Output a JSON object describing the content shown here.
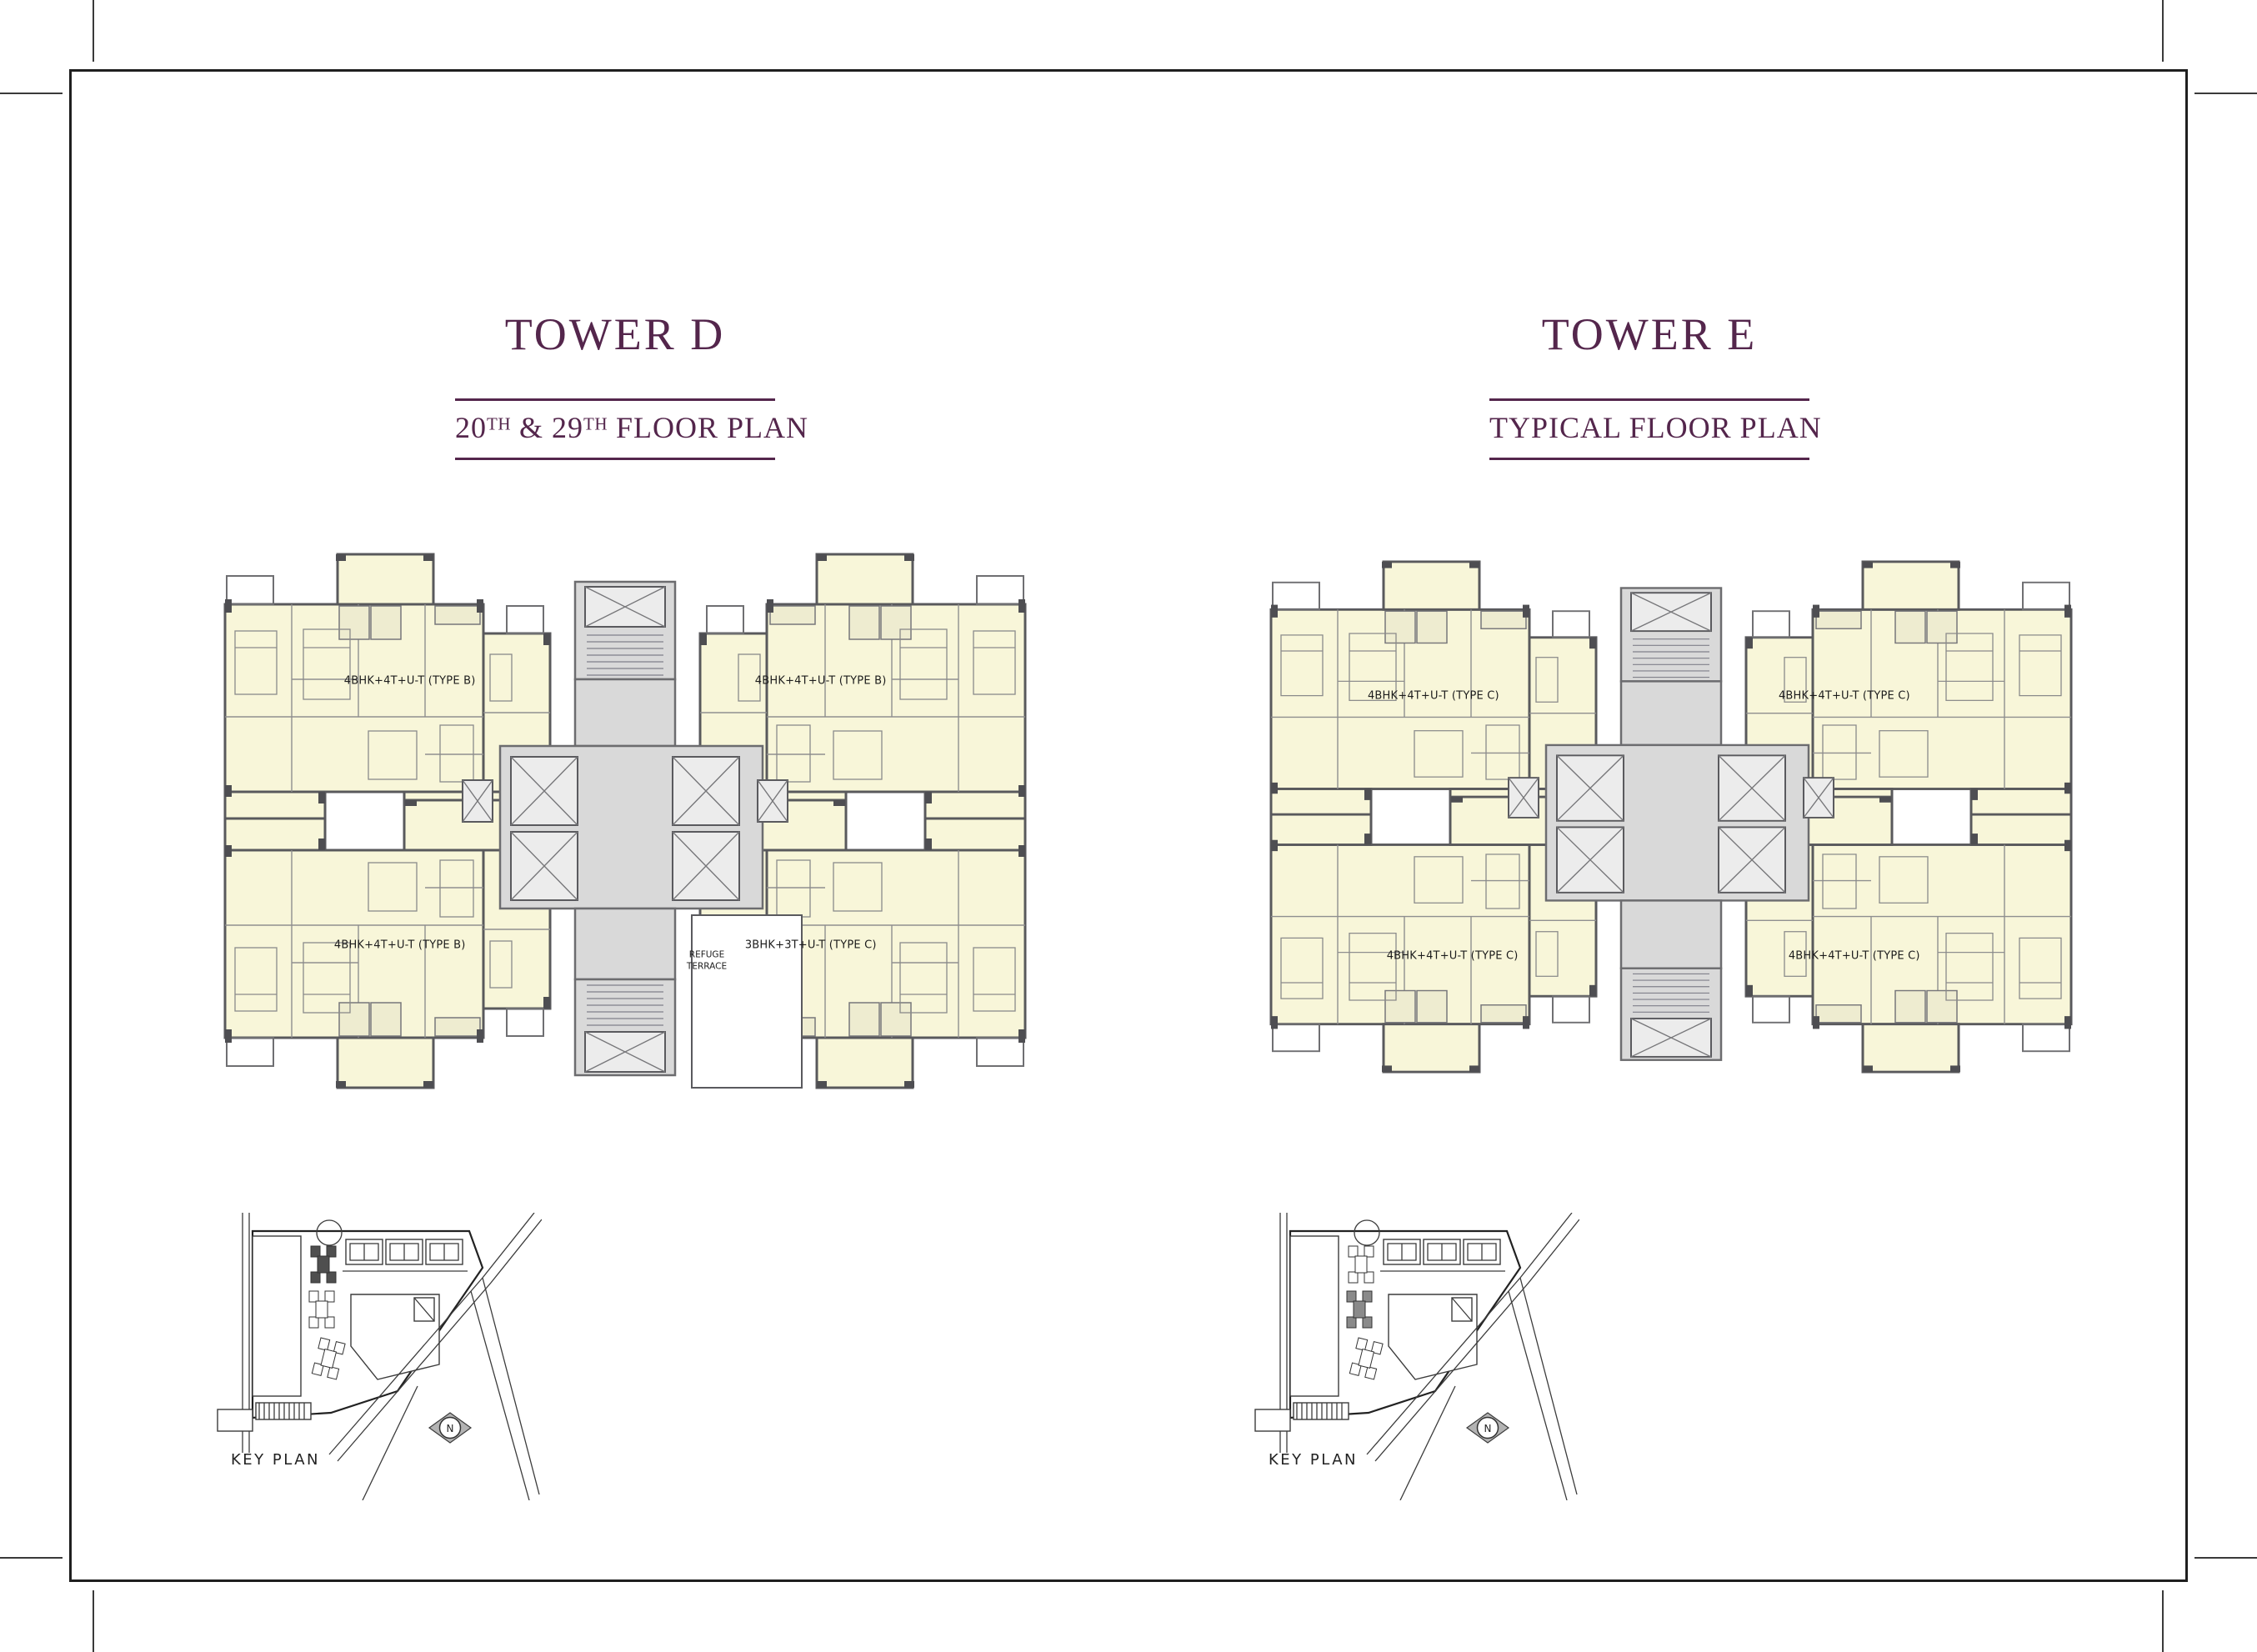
{
  "page": {
    "background": "#ffffff",
    "frame_color": "#1f1f1f",
    "accent_color": "#54264c",
    "plan_fill_color": "#f8f6d9",
    "core_fill_color": "#d9d9d9"
  },
  "key_plan": {
    "compass_label": "N"
  },
  "towers": [
    {
      "title": "TOWER D",
      "subtitle_parts": {
        "p1": "20",
        "sup1": "TH",
        "p2": " & 29",
        "sup2": "TH",
        "p3": " FLOOR PLAN"
      },
      "units": {
        "top_left": "4BHK+4T+U-T (TYPE B)",
        "top_right": "4BHK+4T+U-T (TYPE B)",
        "bottom_left": "4BHK+4T+U-T (TYPE B)",
        "bottom_right": "3BHK+3T+U-T (TYPE C)"
      },
      "refuge": {
        "line1": "REFUGE",
        "line2": "TERRACE"
      },
      "key_plan_label": "KEY PLAN"
    },
    {
      "title": "TOWER E",
      "subtitle_parts": {
        "p3": "TYPICAL FLOOR PLAN"
      },
      "units": {
        "top_left": "4BHK+4T+U-T (TYPE C)",
        "top_right": "4BHK+4T+U-T (TYPE C)",
        "bottom_left": "4BHK+4T+U-T (TYPE C)",
        "bottom_right": "4BHK+4T+U-T (TYPE C)"
      },
      "key_plan_label": "KEY PLAN"
    }
  ]
}
